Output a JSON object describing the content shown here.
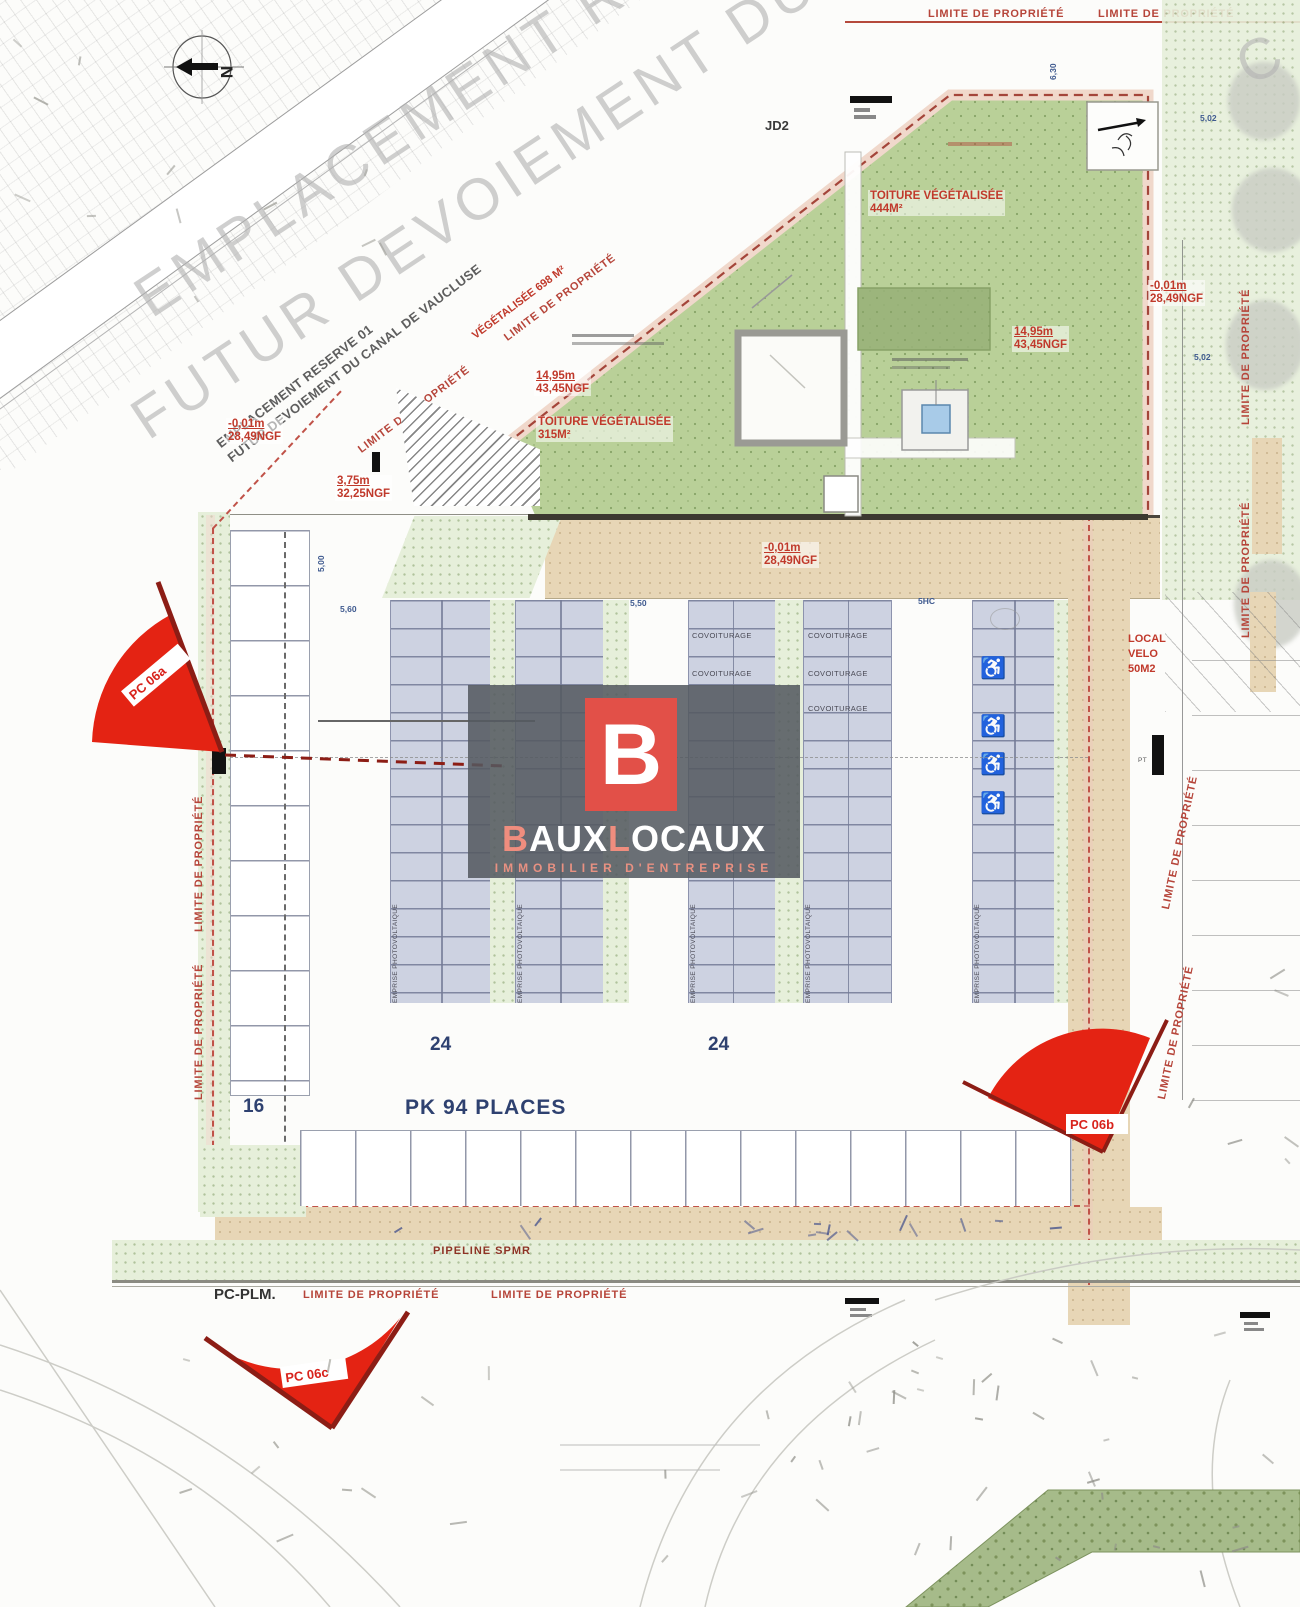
{
  "watermark": {
    "line1": "EMPLACEMENT RESERVE 01",
    "line2": "FUTUR DEVOIEMENT DU CANAL DE",
    "fragment": "C",
    "small_line1": "EMPLACEMENT RESERVE 01",
    "small_line2": "FUTUR DEVOIEMENT DU CANAL DE VAUCLUSE"
  },
  "north": "N",
  "labels": {
    "limite": "LIMITE DE PROPRIÉTÉ",
    "vegetalisee": "VÉGÉTALISÉE 698 M²",
    "jd2": "JD2",
    "pipeline": "PIPELINE SPMR",
    "pc_plm": "PC-PLM.",
    "local_velo": [
      "LOCAL",
      "VELO",
      "50M2"
    ],
    "pt": "PT"
  },
  "roof": {
    "toiture": "TOITURE VÉGÉTALISÉE",
    "area_444": "444M²",
    "area_315": "315M²",
    "elev_height": "14,95m",
    "elev_ngf": "43,45NGF"
  },
  "elevations": {
    "minus": "-0,01m",
    "minus_ngf": "28,49NGF",
    "ramp": "3,75m",
    "ramp_ngf": "32,25NGF"
  },
  "parking": {
    "pk": "PK 94 PLACES",
    "count_24": "24",
    "count_16": "16",
    "count_15": "15",
    "covoiturage": "COVOITURAGE",
    "emprise": "EMPRISE PHOTOVOLTAIQUE",
    "dim_560": "5,60",
    "dim_550": "5,50",
    "dim_5hc": "5HC",
    "dim_500": "5,00",
    "dim_502": "5,02",
    "dim_630": "6,30"
  },
  "markers": {
    "pc_a": "PC 06a",
    "pc_b": "PC 06b",
    "pc_c": "PC 06c"
  },
  "logo": {
    "monogram": "B",
    "t1": "B",
    "t2": "AUX",
    "t3": "L",
    "t4": "OCAUX",
    "subtitle": "IMMOBILIER D'ENTREPRISE"
  },
  "colors": {
    "boundary_red": "#b6453a",
    "label_red": "#c0392b",
    "roof_green": "#b9d098",
    "strip_lavender": "#cdd2e1",
    "drive_tan": "#e7d6b6",
    "text_navy": "#2e4170",
    "marker_red": "#e42313",
    "logo_red": "#e25048",
    "logo_salmon": "#ef8d7e"
  }
}
